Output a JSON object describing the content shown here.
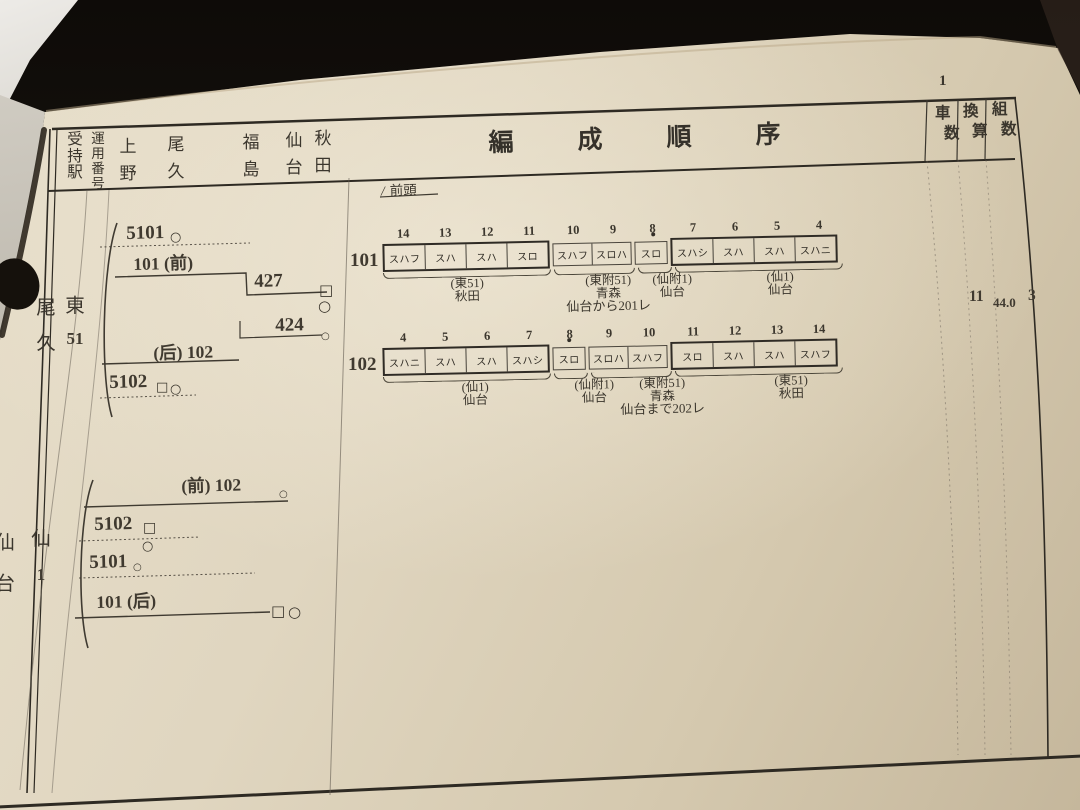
{
  "page": {
    "number": "1"
  },
  "header": {
    "col_station": "受持駅",
    "col_operation": "運用番号",
    "stations": [
      "上野",
      "尾久",
      "福島",
      "仙台",
      "秋田"
    ],
    "title": "編成順序",
    "col_cars": "車数",
    "col_conversion": "換算",
    "col_sets": "組数",
    "front_slash": "/",
    "front_label": "前頭"
  },
  "groups": [
    {
      "station": "尾久",
      "operation": "東51",
      "diagram": {
        "r1": {
          "label": "5101",
          "mark": "○"
        },
        "r2": {
          "label": "101 (前)"
        },
        "r3": {
          "label": "427",
          "mark1": "□",
          "mark2": "○"
        },
        "r4": {
          "label": "424",
          "mark": "○"
        },
        "r5": {
          "label": "(后) 102"
        },
        "r6": {
          "label": "5102",
          "mark1": "□",
          "mark2": "○"
        }
      },
      "totals": {
        "cars": "11",
        "conversion": "44.0",
        "sets": "3"
      }
    },
    {
      "station": "仙台",
      "operation": "仙1",
      "diagram": {
        "r1": {
          "label": "(前) 102",
          "mark": "○"
        },
        "r2": {
          "label": "5102",
          "mark1": "□",
          "mark2": "○"
        },
        "r3": {
          "label": "5101",
          "mark": "○"
        },
        "r4": {
          "label": "101 (后)",
          "mark1": "□",
          "mark2": "○"
        }
      }
    }
  ],
  "formations": [
    {
      "train": "101",
      "cars": [
        {
          "no": "14",
          "type": "スハフ"
        },
        {
          "no": "13",
          "type": "スハ"
        },
        {
          "no": "12",
          "type": "スハ"
        },
        {
          "no": "11",
          "type": "スロ"
        },
        {
          "no": "10",
          "type": "スハフ"
        },
        {
          "no": "9",
          "type": "スロハ"
        },
        {
          "no": "8",
          "type": "スロ"
        },
        {
          "no": "7",
          "type": "スハシ"
        },
        {
          "no": "6",
          "type": "スハ"
        },
        {
          "no": "5",
          "type": "スハ"
        },
        {
          "no": "4",
          "type": "スハニ"
        }
      ],
      "labels": [
        {
          "name": "(東51)",
          "dest": "秋田",
          "note": ""
        },
        {
          "name": "(東附51)",
          "dest": "青森",
          "note": "仙台から201レ"
        },
        {
          "name": "(仙附1)",
          "dest": "仙台",
          "note": ""
        },
        {
          "name": "(仙1)",
          "dest": "仙台",
          "note": ""
        }
      ]
    },
    {
      "train": "102",
      "cars": [
        {
          "no": "4",
          "type": "スハニ"
        },
        {
          "no": "5",
          "type": "スハ"
        },
        {
          "no": "6",
          "type": "スハ"
        },
        {
          "no": "7",
          "type": "スハシ"
        },
        {
          "no": "8",
          "type": "スロ"
        },
        {
          "no": "9",
          "type": "スロハ"
        },
        {
          "no": "10",
          "type": "スハフ"
        },
        {
          "no": "11",
          "type": "スロ"
        },
        {
          "no": "12",
          "type": "スハ"
        },
        {
          "no": "13",
          "type": "スハ"
        },
        {
          "no": "14",
          "type": "スハフ"
        }
      ],
      "labels": [
        {
          "name": "(仙1)",
          "dest": "仙台",
          "note": ""
        },
        {
          "name": "(仙附1)",
          "dest": "仙台",
          "note": ""
        },
        {
          "name": "(東附51)",
          "dest": "青森",
          "note": "仙台まで202レ"
        },
        {
          "name": "(東51)",
          "dest": "秋田",
          "note": ""
        }
      ]
    }
  ]
}
